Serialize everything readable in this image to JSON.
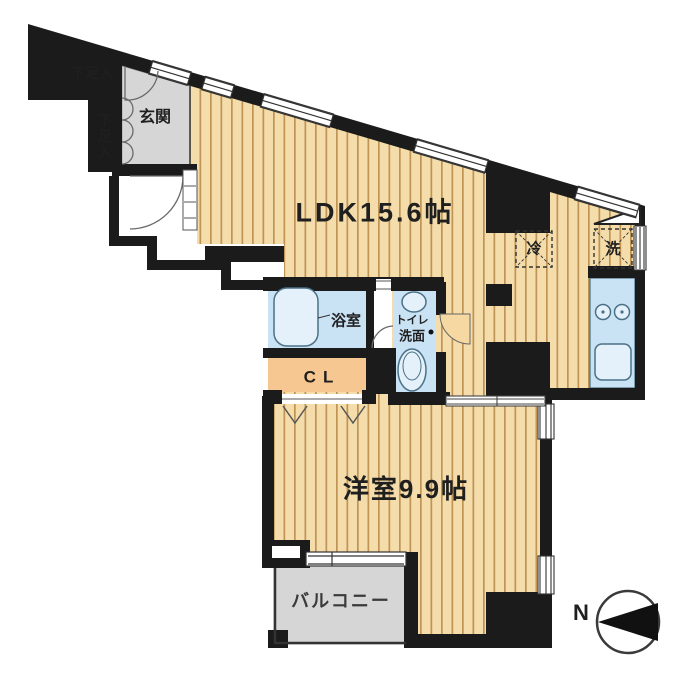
{
  "title": "apartment floor plan",
  "colors": {
    "wall": "#1b1b1b",
    "wood_base": "#f4ddab",
    "wood_stripe": "#bf9455",
    "water_blue": "#c9e2f4",
    "fixture_blue": "#e4f1fb",
    "closet_peach": "#f6c791",
    "door_tan": "#f6d8a2",
    "floor_gray": "#d6d6d6",
    "line_dark": "#333333"
  },
  "rooms": {
    "ldk": {
      "label": "LDK15.6帖"
    },
    "western_room": {
      "label": "洋室9.9帖"
    },
    "entrance": {
      "label": "玄関"
    },
    "bathroom": {
      "label": "浴室"
    },
    "toilet_washroom": {
      "line1": "トイレ",
      "line2": "洗面"
    },
    "closet": {
      "label": "CL"
    },
    "balcony": {
      "label": "バルコニー"
    },
    "shoe_cabinet_upper": {
      "label": "下足入"
    },
    "shoe_cabinet_lower": {
      "label": "下足入"
    },
    "refrigerator_space": {
      "label": "冷"
    },
    "washer_space": {
      "label": "洗"
    }
  },
  "compass": {
    "north_label": "N"
  }
}
